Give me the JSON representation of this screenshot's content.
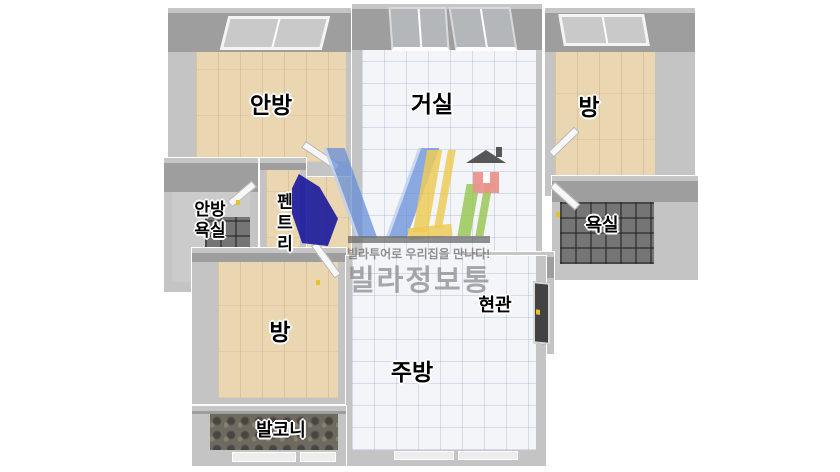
{
  "plan": {
    "rooms": [
      {
        "id": "master-bedroom",
        "label": "안방"
      },
      {
        "id": "living-room",
        "label": "거실"
      },
      {
        "id": "room-top-right",
        "label": "방"
      },
      {
        "id": "master-bathroom",
        "label_line1": "안방",
        "label_line2": "욕실"
      },
      {
        "id": "pantry",
        "label": "펜트리"
      },
      {
        "id": "bathroom",
        "label": "욕실"
      },
      {
        "id": "entrance",
        "label": "현관"
      },
      {
        "id": "room-bottom-left",
        "label": "방"
      },
      {
        "id": "kitchen",
        "label": "주방"
      },
      {
        "id": "balcony",
        "label": "발코니"
      }
    ],
    "floor_colors": {
      "wood": "#ead7b2",
      "tile_light": "#f3f5f8",
      "tile_dark": "#757575",
      "tile_entrance": "#9a9a9a",
      "tile_balcony": "#6f6a60",
      "wall": "#9e9e9e"
    }
  },
  "watermark": {
    "logo_letters": "VLi",
    "tagline": "빌라투어로 우리집을 만나다!",
    "brand": "빌라정보통",
    "colors": {
      "v_blue": "#628cd8",
      "l_yellow": "#edc84a",
      "i_green": "#97c653",
      "house_red": "#e98b83",
      "roof_gray": "#4a4a4a",
      "navy": "#12129b",
      "text_gray": "#8a8a8a"
    }
  }
}
